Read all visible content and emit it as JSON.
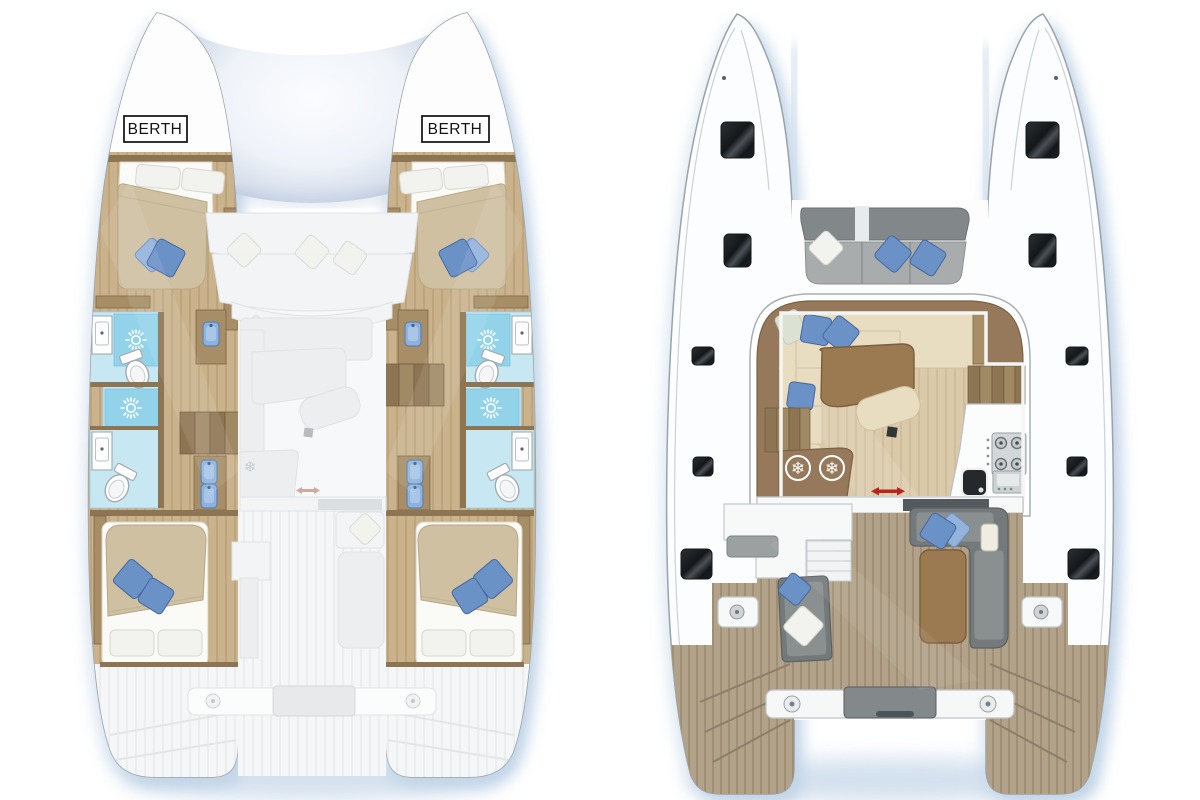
{
  "labels": {
    "berth_port": "BERTH",
    "berth_starboard": "BERTH"
  },
  "icons": {
    "fridge_snowflake": "❄",
    "shower_icon": "sun-rays",
    "sliding_door_arrow": "double-arrow-red"
  },
  "plans": {
    "lower_deck": {
      "cabins": 4,
      "bathrooms": 4,
      "forepeak_berths": 2
    },
    "main_deck": {
      "areas": [
        "forward-cockpit",
        "saloon",
        "galley",
        "aft-cockpit",
        "transom-platform"
      ]
    }
  },
  "colors": {
    "paper": "#ffffff",
    "hull_line": "#9aa3ab",
    "deck_line": "#cbd2d7",
    "shadow_blue": "#b7cde3",
    "tramp_edge": "#b2c4dd",
    "ghost_fill": "#f3f4f5",
    "ghost_line": "#dfe3e6",
    "ghost_shape": "#eceef0",
    "wood_dark": "#8d7452",
    "wood_mid": "#a78e67",
    "wood_plank_dark": "#6e5a3d",
    "cabin_floor": "#c9b28c",
    "cabin_floor_line": "#bda47d",
    "saloon_floor": "#dbcaa9",
    "saloon_floor_line": "#cfbd9b",
    "teak": "#b2a28a",
    "teak_line": "#a18f75",
    "mattress": "#cfc0a1",
    "mattress_edge": "#b7a784",
    "sheet_white": "#fafaf7",
    "pillow_white": "#f2f2ee",
    "pillow_green": "#dce2d3",
    "pillow_blue": "#6b92c7",
    "pillow_blue_light": "#93b2dc",
    "pillow_blue_dark": "#46679e",
    "bath_floor": "#c7e7f3",
    "shower_blue": "#93d3ea",
    "fixture_line": "#a2abb0",
    "seat_back_gray": "#82878a",
    "seat_gray": "#a8acac",
    "sofa_cream": "#e8ddc1",
    "sofa_cream_line": "#d1c3a2",
    "table_brown": "#9b7a52",
    "table_brown_dark": "#7c5e3b",
    "counter_brown": "#96795a",
    "stove_gray": "#d3d7da",
    "window_dark": "#212528",
    "dark_band": "#54595e",
    "red_arrow": "#b5271d",
    "white_struct": "#f7f8f8",
    "struct_line": "#c3c9cd"
  }
}
